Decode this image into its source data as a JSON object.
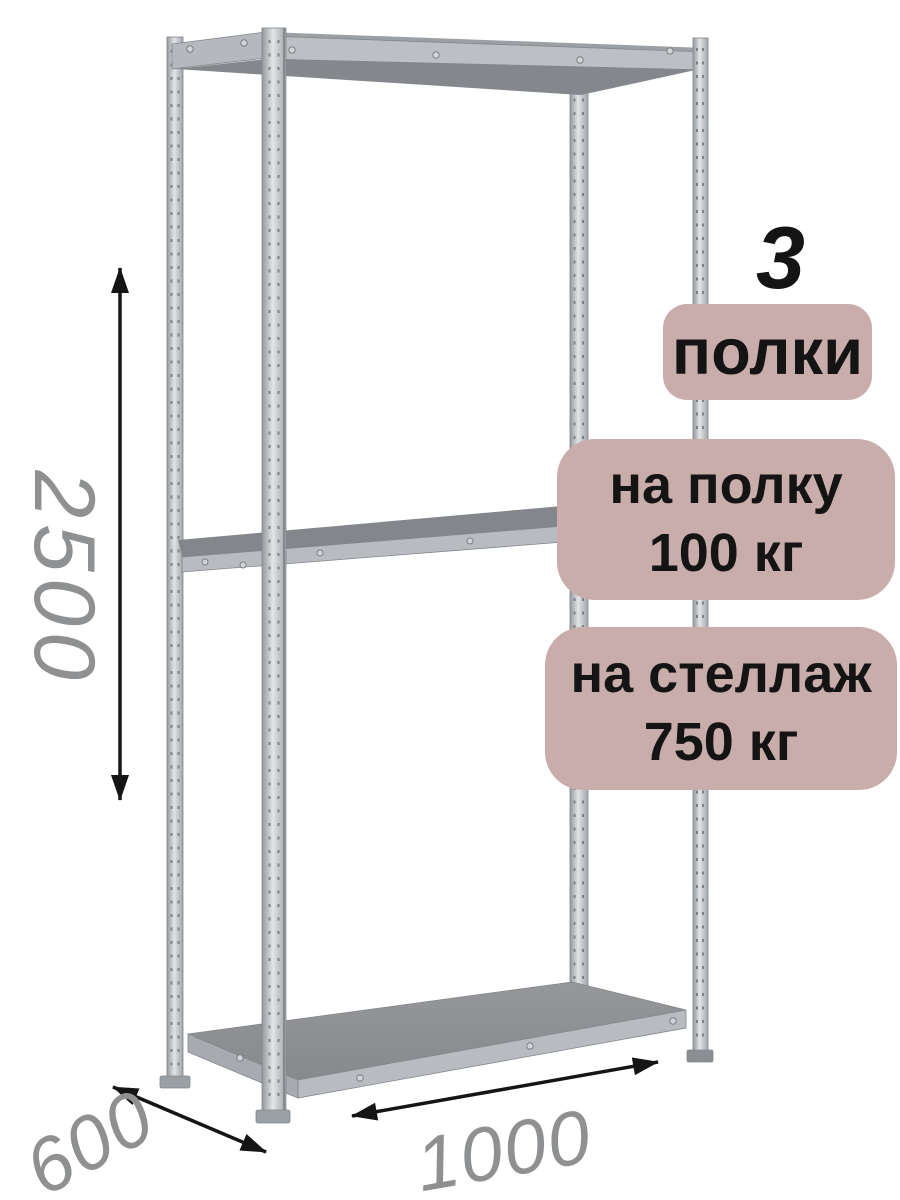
{
  "badges": {
    "count_number": "3",
    "count_label": "полки",
    "per_shelf": {
      "line1": "на полку",
      "line2": "100 кг"
    },
    "per_rack": {
      "line1": "на стеллаж",
      "line2": "750 кг"
    }
  },
  "dimensions": {
    "height_mm": "2500",
    "depth_mm": "600",
    "width_mm": "1000"
  },
  "colors": {
    "badge_bg": "#c9adab",
    "badge_text": "#141414",
    "dimension_text": "#8e9092",
    "arrow": "#151515",
    "metal_light": "#c9ccd0",
    "metal_mid": "#a9adb1",
    "metal_dark": "#85888c",
    "background": "#ffffff"
  }
}
